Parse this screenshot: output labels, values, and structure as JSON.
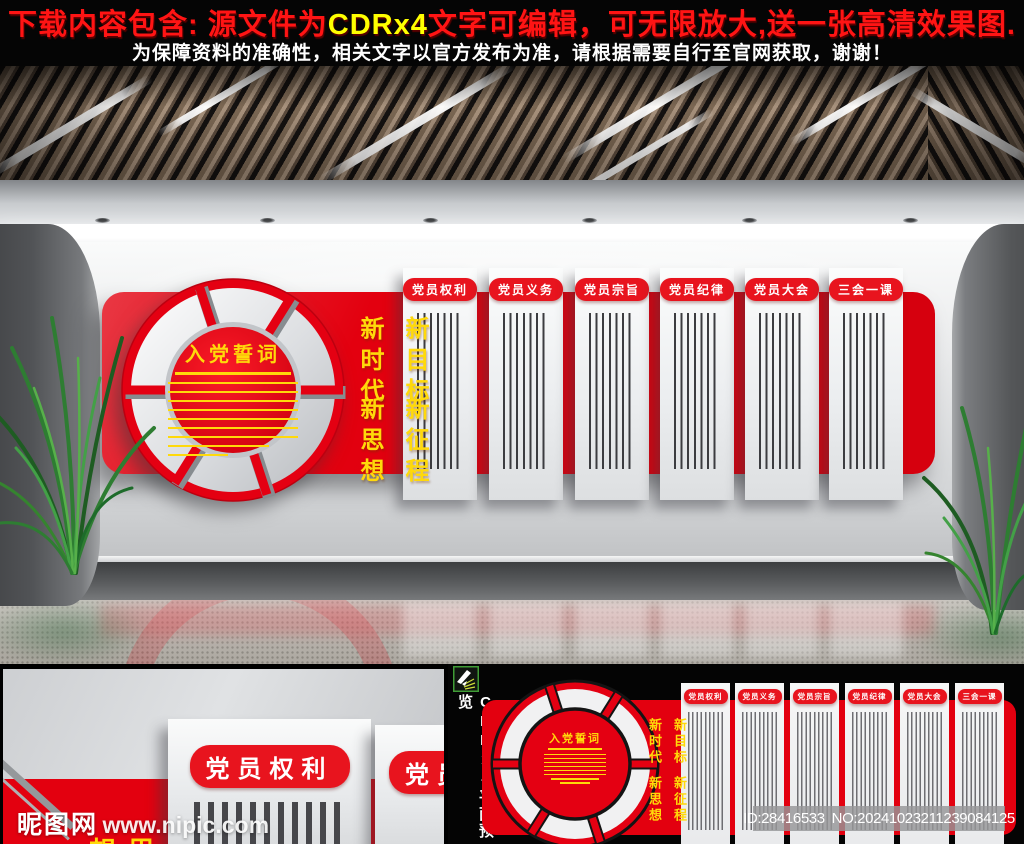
{
  "banner": {
    "line1_prefix": "下载内容包含: 源文件为",
    "line1_highlight": "CDRx4",
    "line1_suffix": "文字可编辑，可无限放大,送一张高清效果图.",
    "line2": "为保障资料的准确性，相关文字以官方发布为准，请根据需要自行至官网获取，谢谢！"
  },
  "design": {
    "center_title": "入党誓词",
    "slogan": {
      "col1": "新时代",
      "col2": "新目标",
      "col3": "新思想",
      "col4": "新征程"
    },
    "panels": [
      {
        "label": "党员权利"
      },
      {
        "label": "党员义务"
      },
      {
        "label": "党员宗旨"
      },
      {
        "label": "党员纪律"
      },
      {
        "label": "党员大会"
      },
      {
        "label": "三会一课"
      }
    ]
  },
  "preview": {
    "side_label": "CDRx4平面预览"
  },
  "watermark": {
    "site_name": "昵图网",
    "site_url": "www.nipic.com"
  },
  "stock_info": {
    "id": "ID:28416533",
    "no": "NO:20241023211239084125"
  },
  "colors": {
    "brand_red": "#e3000f",
    "accent_yellow": "#ffd90a",
    "banner_text_red": "#ff1414",
    "banner_highlight_yellow": "#ffff00"
  }
}
